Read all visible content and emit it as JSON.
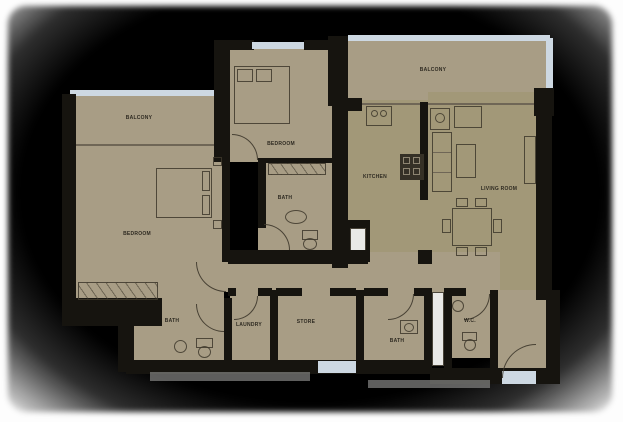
{
  "plan": {
    "type": "apartment-floor-plan",
    "labels": {
      "balcony_left": "BALCONY",
      "master_bedroom": "BEDROOM",
      "bedroom": "BEDROOM",
      "bath_top": "BATH",
      "balcony_right": "BALCONY",
      "kitchen": "KITCHEN",
      "living_room": "LIVING ROOM",
      "bath_left": "BATH",
      "laundry": "LAUNDRY",
      "store": "STORE",
      "bath_mid": "BATH",
      "wc": "W.C."
    },
    "colors": {
      "floor": "#a89d85",
      "floor2": "#a29878",
      "wall": "#16140f",
      "glass": "#cdd8e2",
      "line": "#6f6656",
      "shaft": "#e9e9e7",
      "tab": "#7e7e7c"
    }
  }
}
